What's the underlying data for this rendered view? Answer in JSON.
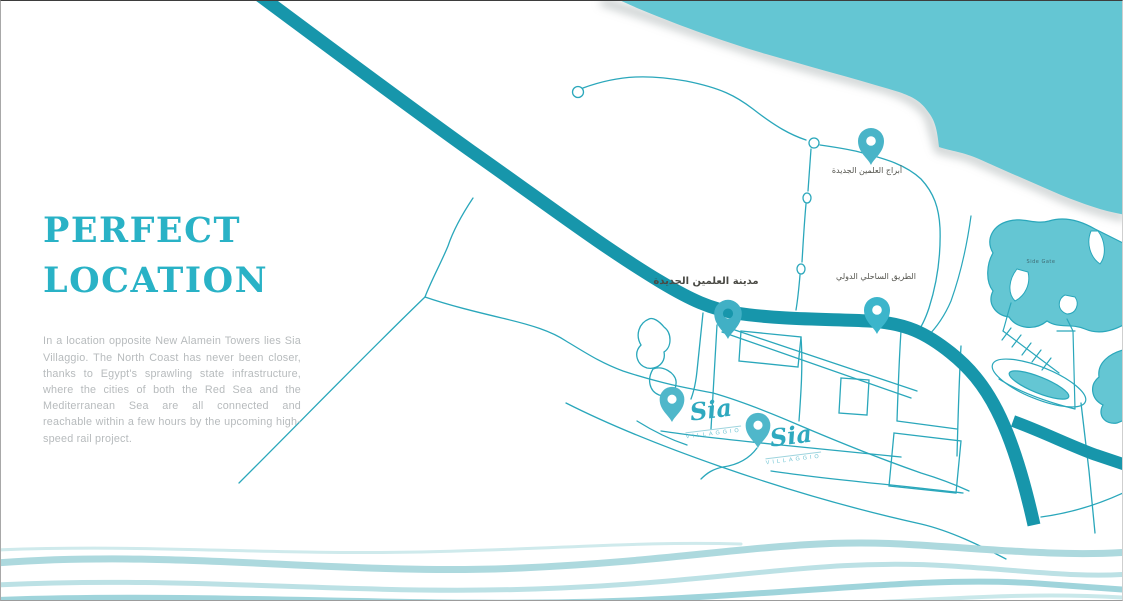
{
  "intro": {
    "title_line1": "PERFECT",
    "title_line2": "LOCATION",
    "paragraph": "In a location opposite New Alamein Towers lies Sia Villaggio. The North Coast has never been closer, thanks to Egypt's sprawling state infrastructure, where the cities of both the Red Sea and the Mediterranean Sea are all connected and reachable within a few hours by the upcoming high-speed rail project."
  },
  "map": {
    "pois": [
      {
        "id": "new-alamein-towers",
        "label_ar": "أبراج العلمين الجديدة"
      },
      {
        "id": "new-alamein-city",
        "label_ar": "مدينة العلمين الجديدة"
      },
      {
        "id": "international-coastal-road",
        "label_ar": "الطريق الساحلي الدولي"
      },
      {
        "id": "sia-villaggio-north",
        "brand": "Sia",
        "brand_sub": "VILLAGGIO"
      },
      {
        "id": "sia-villaggio-south",
        "brand": "Sia",
        "brand_sub": "VILLAGGIO"
      }
    ],
    "lake_label": "Side Gate",
    "colors": {
      "sea": "#64c6d3",
      "road_primary": "#1796ab",
      "road_secondary": "#2aa7bb",
      "pin": "#49b4c8",
      "title_accent": "#29b2c6",
      "body_text": "#b7bbbd",
      "wave": "#aedbe0"
    }
  }
}
